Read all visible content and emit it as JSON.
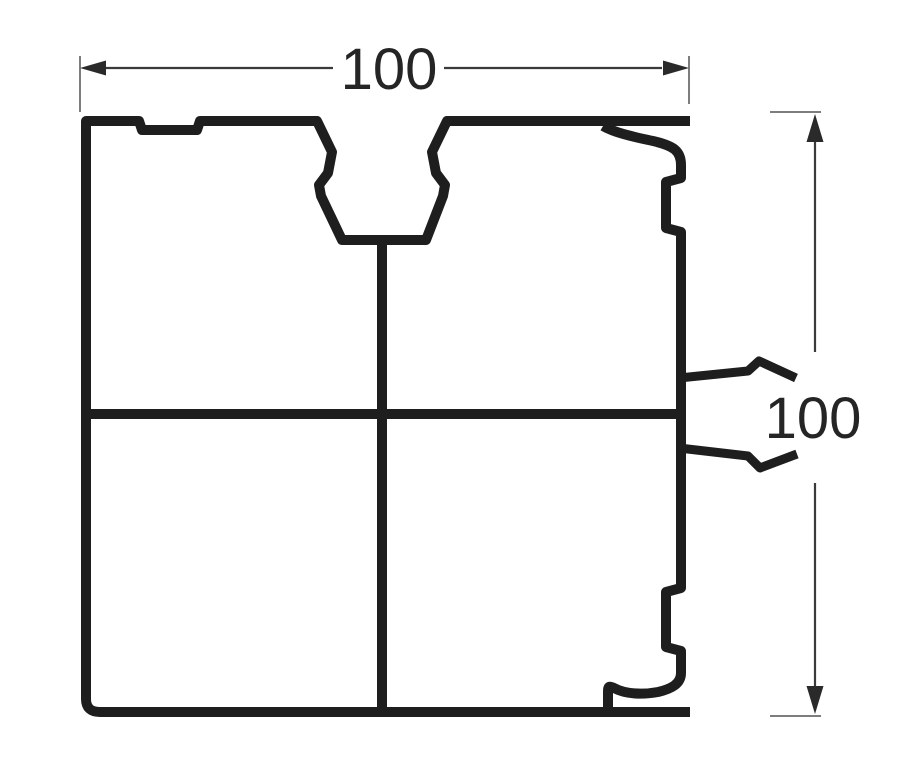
{
  "figure": {
    "kind": "profile-cross-section-drawing",
    "width_dimension": "100",
    "height_dimension": "100"
  },
  "colors": {
    "profile_line": "#1e1e1e",
    "dimension_line": "#3a3a3a",
    "tick_line": "#7d7d7d",
    "arrow_fill": "#2a2a2a",
    "label_text": "#252525",
    "background": "#ffffff"
  }
}
